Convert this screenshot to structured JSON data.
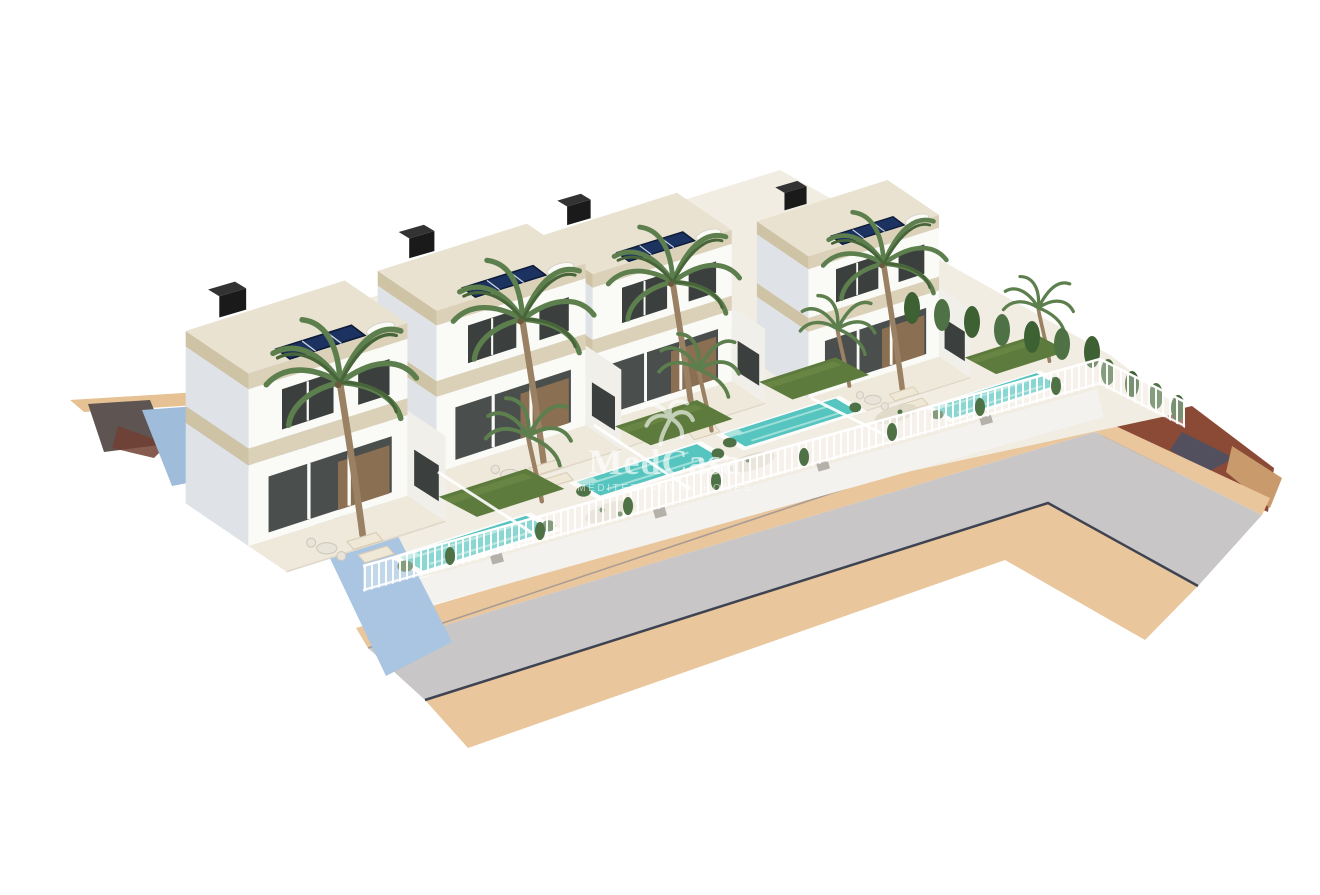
{
  "scene": {
    "type": "3d-architectural-render",
    "villa_count": 4,
    "pool_count": 4,
    "features": [
      "two-storey white villas with beige travertine fascias",
      "flat roofs with dark-blue solar panels and black chimneys",
      "palm trees",
      "private turquoise pools with white decks",
      "green lawns and sun loungers",
      "white picket perimeter fences with cypress hedges",
      "light-blue boundary retaining wall",
      "grey asphalt road with sand-coloured sidewalks curving at the right",
      "reddish terrain patch at the right edge",
      "white background"
    ]
  },
  "watermark": {
    "title": "MedCasa",
    "subtitle": "MEDITERRANEAN HOMES",
    "icon": "palm-tree"
  },
  "colors": {
    "background": "#ffffff",
    "house_white": "#fafaf7",
    "house_shadow": "#dfe3e8",
    "fascia": "#dbd1b8",
    "fascia_dark": "#cfc3a6",
    "roof_top": "#e9e2d0",
    "window_dark": "#3b403f",
    "glass_dark": "#4a4f4e",
    "interior_warm": "#8a6f52",
    "chimney": "#1a1a1a",
    "chimney_top": "#333333",
    "solar": "#1c3260",
    "porch": "#efe9dc",
    "lawn": "#5e7b3e",
    "lawn_light": "#6f8c4a",
    "pool_rim": "#fcfcfb",
    "pool": "#56c4bf",
    "pool_light": "#ace4dd",
    "lounger": "#f0e8d6",
    "trunk": "#9b8164",
    "frond": "#5d7f4e",
    "frond_dark": "#476539",
    "cypress": "#3e6134",
    "shrub": "#4e7245",
    "gravel": "#ded7c7",
    "fence_white": "#ffffff",
    "plot": "#f2ede3",
    "wall_blue": "#a9c5e2",
    "wall_blue2": "#9fbcdb",
    "wall_white": "#f3f2ef",
    "road": "#c9c6c7",
    "sidewalk": "#e9c69c",
    "sand": "#e5c193",
    "curb": "#3e4352",
    "asphalt_patch": "#5e5452",
    "patch_red": "#713f33",
    "terrain_red": "#8b4a36",
    "terrain_shadow": "#44506a",
    "terrain_sand": "#c99a6c",
    "watermark": "#ffffff"
  }
}
